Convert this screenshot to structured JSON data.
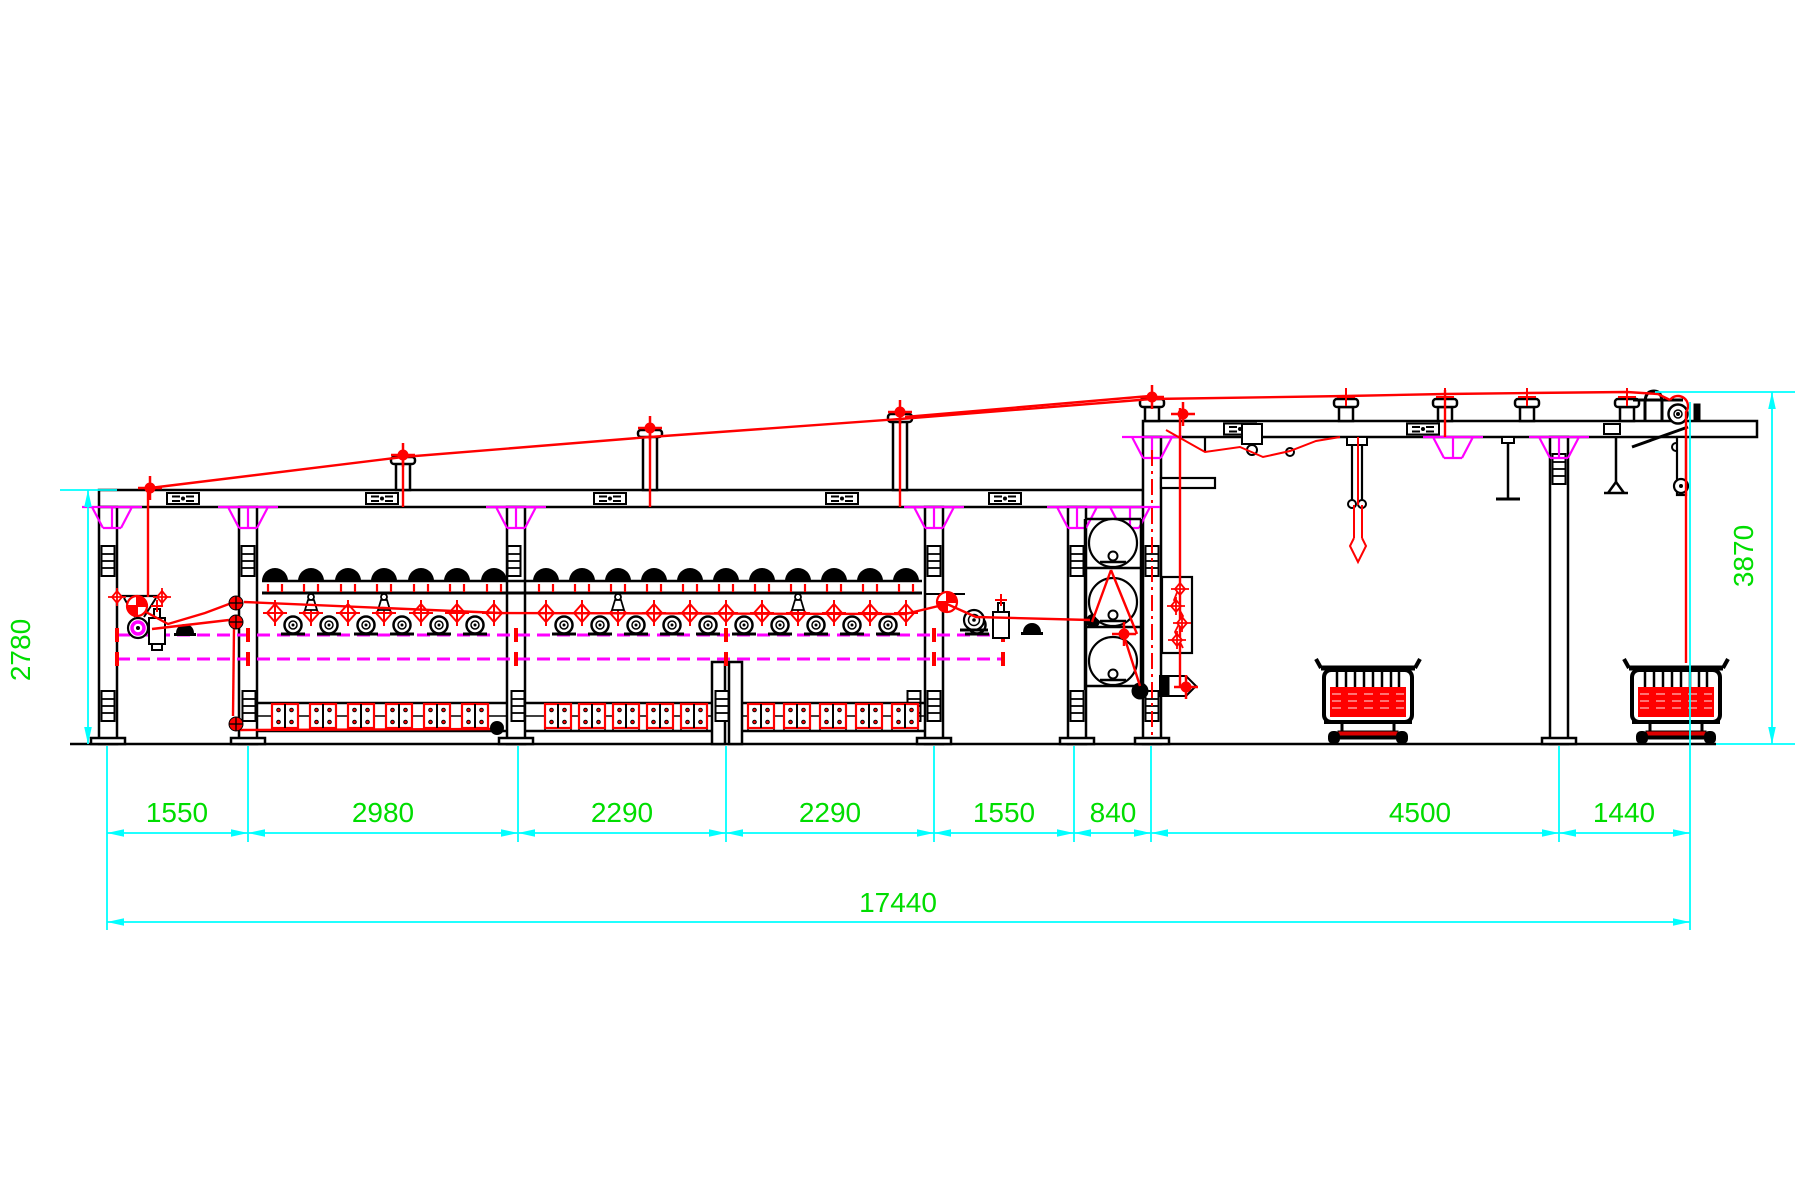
{
  "drawing": {
    "kind": "machine-line-side-elevation",
    "dimensions": {
      "bottom_segments": [
        "1550",
        "2980",
        "2290",
        "2290",
        "1550",
        "840",
        "4500",
        "1440"
      ],
      "bottom_total": "17440",
      "left_height": "2780",
      "right_height": "3870"
    },
    "colors": {
      "outline_black": "#000000",
      "detail_red": "#ff0000",
      "accent_magenta": "#ff00ff",
      "dimension_line_cyan": "#00ffff",
      "dimension_text_green": "#00dd00",
      "background": "#ffffff"
    }
  }
}
